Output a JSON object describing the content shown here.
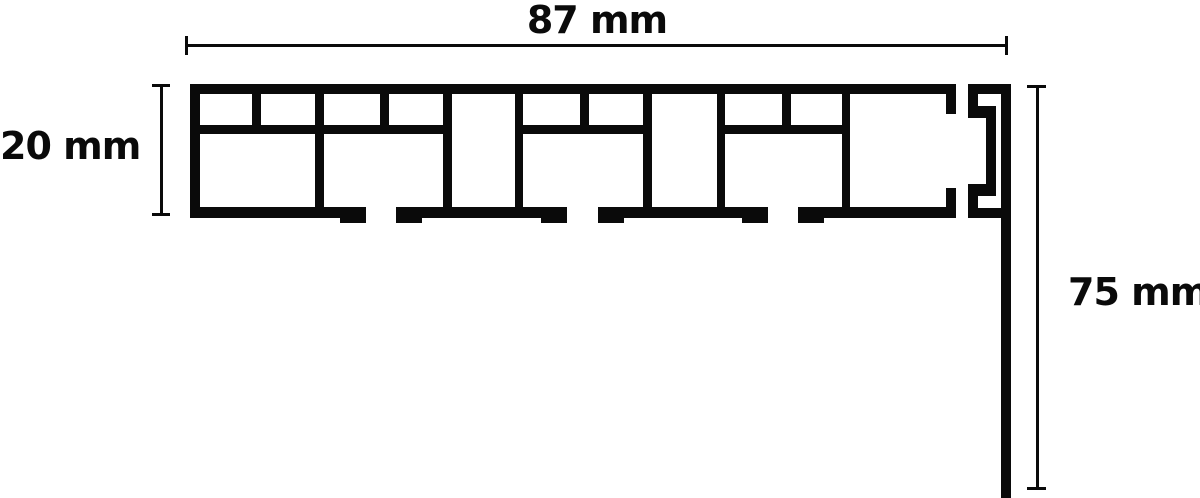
{
  "diagram": {
    "ink_color": "#0a0a0a",
    "background_color": "#ffffff",
    "dims": {
      "width": {
        "label": "87 mm"
      },
      "height": {
        "label": "20 mm"
      },
      "drop": {
        "label": "75 mm"
      }
    }
  }
}
